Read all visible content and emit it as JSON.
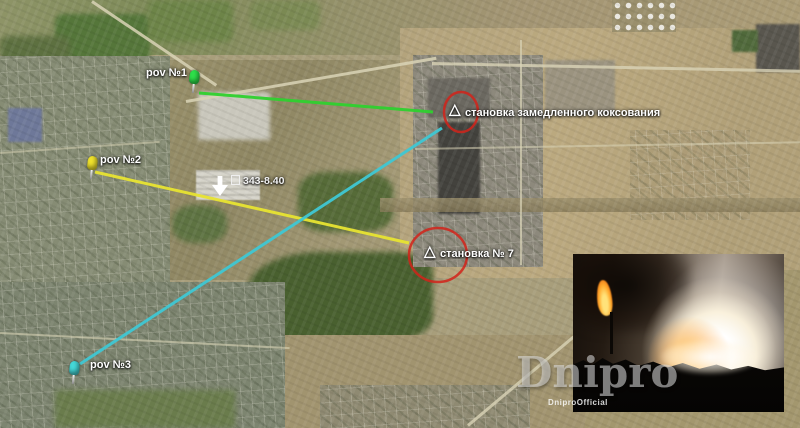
{
  "colors": {
    "pov1_line": "#2fd12f",
    "pov2_line": "#e8e432",
    "pov3_line": "#3fc8d4",
    "circle_stroke": "#d2231a",
    "pin1": "#2ee04a",
    "pin2": "#f0e32c",
    "pin3": "#45d9d9",
    "label_text": "#ffffff"
  },
  "markers": {
    "pov1": {
      "label": "pov №1"
    },
    "pov2": {
      "label": "pov №2"
    },
    "pov3": {
      "label": "pov №3"
    }
  },
  "annotations": {
    "triangle_glyph": "△",
    "coking_unit_label": "становка замедленного коксования",
    "unit7_label": "становка № 7",
    "arrow_note_label": "343-8.40"
  },
  "watermark": {
    "title": "Dnipro",
    "subtitle": "DniproOfficial"
  }
}
